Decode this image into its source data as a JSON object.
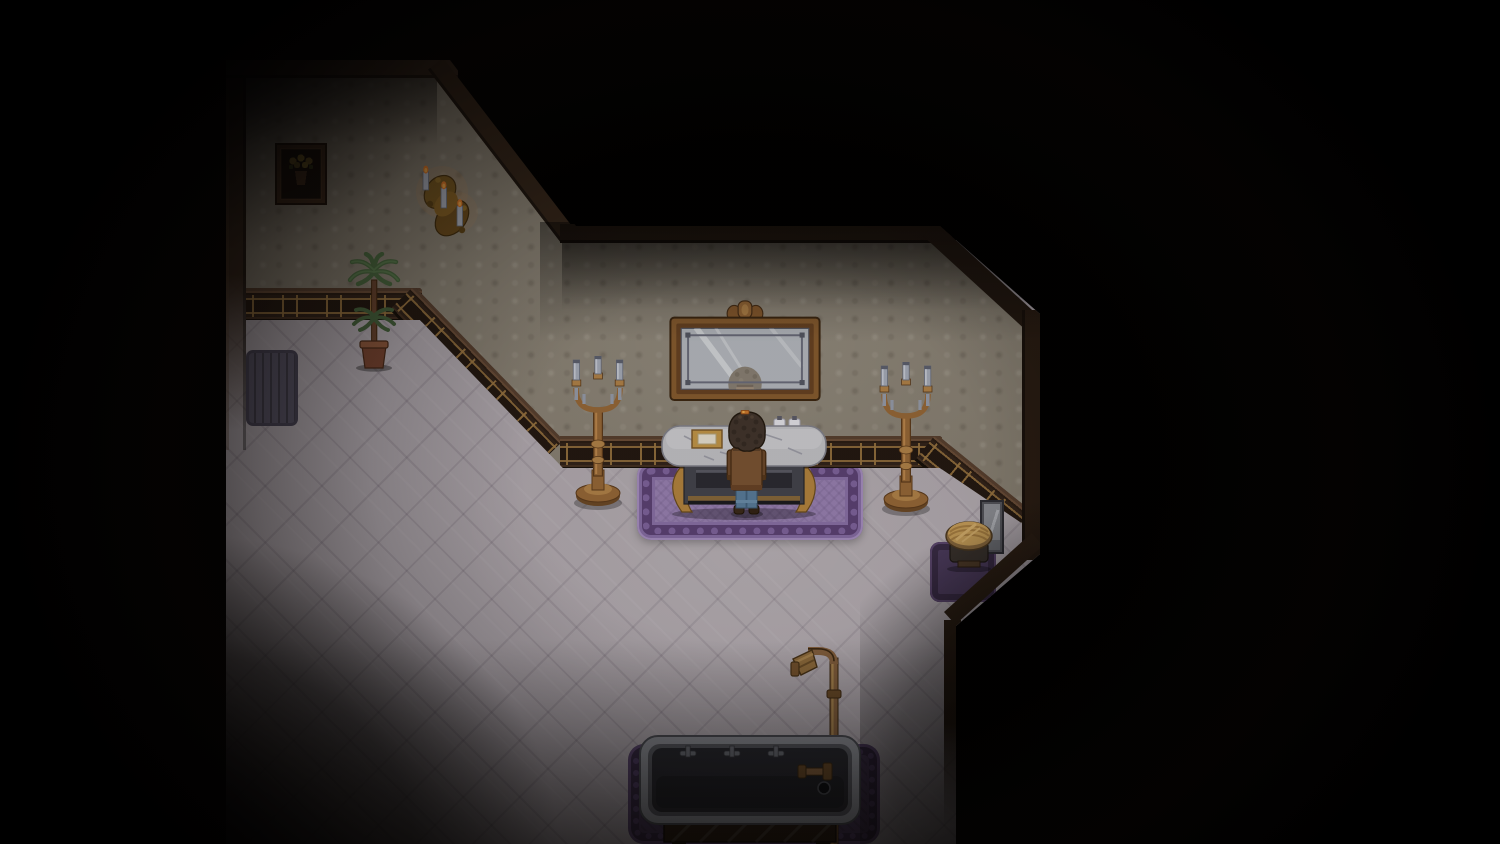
{
  "scene": {
    "title": "Top-down pixel-art game scene",
    "description": "Dimly lit Victorian bathroom in a top-down pixel-art game: a player character stands at a marble washstand beneath a gilded mirror, flanked by brass candelabras, with a bathtub and shower pipe at the bottom and darkness surrounding the room",
    "room": "Victorian bathroom at night",
    "objects": [
      {
        "id": "framed-flower-painting",
        "label": "Framed painting of yellow flowers"
      },
      {
        "id": "wall-candle-sconce",
        "label": "Brass wall sconce with three lit candles"
      },
      {
        "id": "potted-palm",
        "label": "Potted palm plant"
      },
      {
        "id": "floor-mat",
        "label": "Striped slate floor mat"
      },
      {
        "id": "wall-mirror",
        "label": "Gilded wall mirror reflecting the character's head"
      },
      {
        "id": "candelabra-left",
        "label": "Brass floor candelabra with unlit candles"
      },
      {
        "id": "candelabra-right",
        "label": "Brass floor candelabra with unlit candles"
      },
      {
        "id": "washstand",
        "label": "Marble-top washstand with gold tray and two bottles"
      },
      {
        "id": "player-character",
        "label": "Player character with curly brown hair, brown coat and jeans"
      },
      {
        "id": "ornate-rug",
        "label": "Purple ornate rug"
      },
      {
        "id": "wicker-stool",
        "label": "Round wicker hamper stool"
      },
      {
        "id": "leaning-mirror",
        "label": "Small grey mirror leaning against wall"
      },
      {
        "id": "shower-pipe",
        "label": "Brass shower pipe with shower head"
      },
      {
        "id": "bathtub",
        "label": "Grey bathtub on wooden bench with faucet handles"
      },
      {
        "id": "bathtub-rug",
        "label": "Dark purple bath rug"
      }
    ],
    "palette": {
      "background": "#000000",
      "wallpaper": "#8b8375",
      "wainscot_wood": "#33241a",
      "wainscot_gold": "#9e7842",
      "trim": "#3a2a1e",
      "floor": "#b4acb2",
      "rug": "#9c84b6",
      "rug_border": "#5e4477",
      "brass": "#9a6a38",
      "marble": "#c7c7cb",
      "tub_grey": "#2b2b31",
      "candle": "#aab0bd",
      "flame": "#e07a2a",
      "hair": "#43362d",
      "coat": "#7d5634",
      "jeans": "#5b7f9e"
    }
  }
}
